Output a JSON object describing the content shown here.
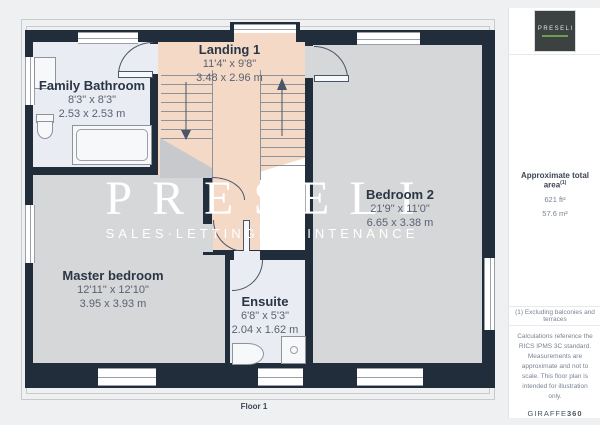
{
  "floorplan": {
    "floor_label": "Floor 1",
    "rooms": [
      {
        "name": "Landing 1",
        "imperial": "11'4\" x 9'8\"",
        "metric": "3.48 x 2.96 m"
      },
      {
        "name": "Family Bathroom",
        "imperial": "8'3\" x 8'3\"",
        "metric": "2.53 x 2.53 m"
      },
      {
        "name": "Bedroom 2",
        "imperial": "21'9\" x 11'0\"",
        "metric": "6.65 x 3.38 m"
      },
      {
        "name": "Master bedroom",
        "imperial": "12'11\" x 12'10\"",
        "metric": "3.95 x 3.93 m"
      },
      {
        "name": "Ensuite",
        "imperial": "6'8\" x 5'3\"",
        "metric": "2.04 x 1.62 m"
      }
    ],
    "watermark": {
      "title": "PRESELI",
      "subtitle": "SALES·LETTINGS·MAINTENANCE"
    }
  },
  "sidebar": {
    "logo": {
      "text": "PRESELI"
    },
    "area": {
      "label": "Approximate total area",
      "superscript": "(1)",
      "imperial": "621 ft²",
      "metric": "57.6 m²"
    },
    "footnote": "(1) Excluding balconies and terraces",
    "disclaimer": "Calculations reference the RICS IPMS 3C standard. Measurements are approximate and not to scale. This floor plan is intended for illustration only.",
    "brand": {
      "light": "GIRAFFE",
      "bold": "360"
    }
  },
  "colors": {
    "wall": "#222d3b",
    "landing": "#f3d9c6",
    "bedroom": "#d6d7d9",
    "bathroom": "#e9ecf3",
    "logo_accent": "#6f9f4e",
    "background": "#eff0f1"
  }
}
